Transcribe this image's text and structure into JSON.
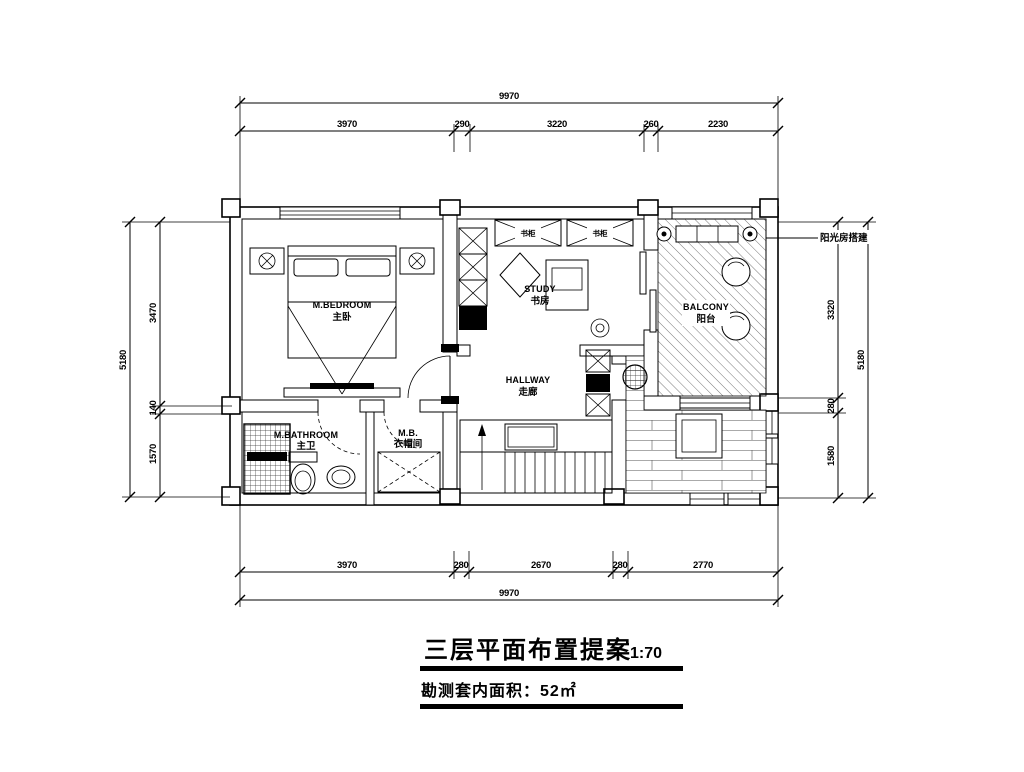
{
  "title_block": {
    "title": "三层平面布置提案",
    "scale": "1:70",
    "area_label": "勘测套内面积：52㎡"
  },
  "annotations": {
    "sunroom": "阳光房搭建"
  },
  "rooms": {
    "bedroom": {
      "en": "M.BEDROOM",
      "cn": "主卧"
    },
    "study": {
      "en": "STUDY",
      "cn": "书房"
    },
    "balcony": {
      "en": "BALCONY",
      "cn": "阳台"
    },
    "hallway": {
      "en": "HALLWAY",
      "cn": "走廊"
    },
    "bathroom": {
      "en": "M.BATHROOM",
      "cn": "主卫"
    },
    "closet": {
      "en": "M.B.",
      "cn": "衣帽间"
    }
  },
  "cabinets": {
    "bookcase_left": "书柜",
    "bookcase_right": "书柜"
  },
  "dimensions": {
    "top": {
      "total": "9970",
      "segments": [
        "3970",
        "290",
        "3220",
        "260",
        "2230"
      ]
    },
    "bottom": {
      "total": "9970",
      "segments": [
        "3970",
        "280",
        "2670",
        "280",
        "2770"
      ]
    },
    "left": {
      "total": "5180",
      "segments": [
        "3470",
        "140",
        "1570"
      ]
    },
    "right": {
      "total": "5180",
      "segments": [
        "3320",
        "280",
        "1580"
      ]
    }
  }
}
